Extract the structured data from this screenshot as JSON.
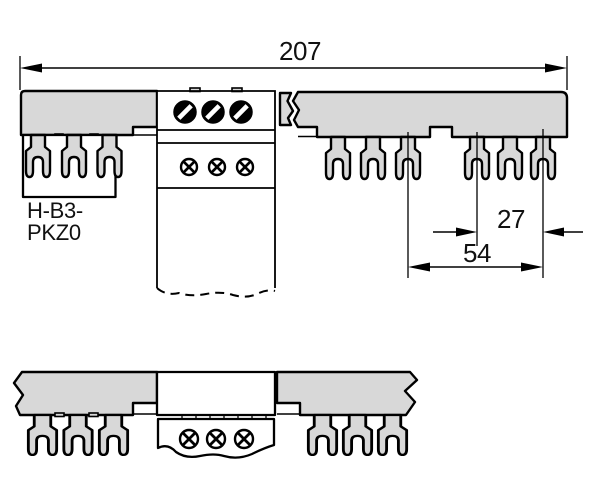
{
  "drawing": {
    "part_label": {
      "line1": "H-B3-",
      "line2": "PKZ0"
    },
    "dimensions": {
      "overall_width": "207",
      "pole_pitch": "27",
      "device_pitch": "54"
    }
  },
  "colors": {
    "busbar_fill": "#d8d8d8",
    "outline": "#000000",
    "background": "#ffffff"
  }
}
